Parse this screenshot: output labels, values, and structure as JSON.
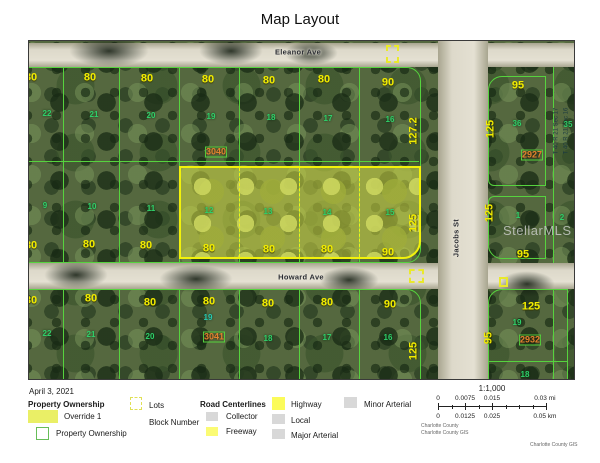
{
  "title": "Map Layout",
  "date": "April 3, 2021",
  "map": {
    "section": {
      "line1": "T 40  R 21  Sec 17",
      "line2": "T 40  R 21  Sec 16"
    },
    "watermark": "StellarMLS",
    "labels": [
      {
        "t": "80",
        "x": 2,
        "y": 37,
        "c": "w"
      },
      {
        "t": "80",
        "x": 61,
        "y": 37,
        "c": "w"
      },
      {
        "t": "80",
        "x": 118,
        "y": 38,
        "c": "w"
      },
      {
        "t": "80",
        "x": 179,
        "y": 39,
        "c": "w"
      },
      {
        "t": "80",
        "x": 240,
        "y": 40,
        "c": "w"
      },
      {
        "t": "80",
        "x": 295,
        "y": 39,
        "c": "w"
      },
      {
        "t": "90",
        "x": 359,
        "y": 42,
        "c": "w"
      },
      {
        "t": "95",
        "x": 489,
        "y": 45,
        "c": "w"
      },
      {
        "t": "80",
        "x": 2,
        "y": 205,
        "c": "w"
      },
      {
        "t": "80",
        "x": 60,
        "y": 204,
        "c": "w"
      },
      {
        "t": "80",
        "x": 117,
        "y": 205,
        "c": "w"
      },
      {
        "t": "80",
        "x": 180,
        "y": 208,
        "c": "w"
      },
      {
        "t": "80",
        "x": 240,
        "y": 209,
        "c": "w"
      },
      {
        "t": "80",
        "x": 298,
        "y": 209,
        "c": "w"
      },
      {
        "t": "90",
        "x": 359,
        "y": 212,
        "c": "w"
      },
      {
        "t": "95",
        "x": 494,
        "y": 214,
        "c": "w"
      },
      {
        "t": "80",
        "x": 2,
        "y": 260,
        "c": "w"
      },
      {
        "t": "80",
        "x": 62,
        "y": 258,
        "c": "w"
      },
      {
        "t": "80",
        "x": 121,
        "y": 262,
        "c": "w"
      },
      {
        "t": "80",
        "x": 180,
        "y": 261,
        "c": "w"
      },
      {
        "t": "80",
        "x": 239,
        "y": 263,
        "c": "w"
      },
      {
        "t": "80",
        "x": 298,
        "y": 262,
        "c": "w"
      },
      {
        "t": "90",
        "x": 361,
        "y": 264,
        "c": "w"
      },
      {
        "t": "125",
        "x": 502,
        "y": 266,
        "c": "w"
      },
      {
        "t": "22",
        "x": 18,
        "y": 73,
        "c": "lot"
      },
      {
        "t": "21",
        "x": 65,
        "y": 74,
        "c": "lot"
      },
      {
        "t": "20",
        "x": 122,
        "y": 75,
        "c": "lot"
      },
      {
        "t": "19",
        "x": 182,
        "y": 76,
        "c": "lot"
      },
      {
        "t": "18",
        "x": 242,
        "y": 77,
        "c": "lot"
      },
      {
        "t": "17",
        "x": 299,
        "y": 78,
        "c": "lot"
      },
      {
        "t": "16",
        "x": 361,
        "y": 79,
        "c": "lot"
      },
      {
        "t": "36",
        "x": 488,
        "y": 83,
        "c": "lot"
      },
      {
        "t": "35",
        "x": 539,
        "y": 84,
        "c": "lot"
      },
      {
        "t": "9",
        "x": 16,
        "y": 165,
        "c": "lot"
      },
      {
        "t": "10",
        "x": 63,
        "y": 166,
        "c": "lot"
      },
      {
        "t": "11",
        "x": 122,
        "y": 168,
        "c": "lot"
      },
      {
        "t": "12",
        "x": 180,
        "y": 170,
        "c": "lot"
      },
      {
        "t": "13",
        "x": 239,
        "y": 171,
        "c": "lot"
      },
      {
        "t": "14",
        "x": 298,
        "y": 172,
        "c": "lot"
      },
      {
        "t": "15",
        "x": 361,
        "y": 172,
        "c": "lot"
      },
      {
        "t": "1",
        "x": 489,
        "y": 175,
        "c": "lot"
      },
      {
        "t": "2",
        "x": 533,
        "y": 177,
        "c": "lot"
      },
      {
        "t": "22",
        "x": 18,
        "y": 293,
        "c": "lot"
      },
      {
        "t": "21",
        "x": 62,
        "y": 294,
        "c": "lot"
      },
      {
        "t": "20",
        "x": 121,
        "y": 296,
        "c": "lot"
      },
      {
        "t": "19",
        "x": 179,
        "y": 277,
        "c": "lotteal"
      },
      {
        "t": "18",
        "x": 239,
        "y": 298,
        "c": "lot"
      },
      {
        "t": "17",
        "x": 298,
        "y": 297,
        "c": "lot"
      },
      {
        "t": "16",
        "x": 359,
        "y": 297,
        "c": "lot"
      },
      {
        "t": "19",
        "x": 488,
        "y": 282,
        "c": "lot"
      },
      {
        "t": "18",
        "x": 496,
        "y": 334,
        "c": "lot"
      },
      {
        "t": "3040",
        "x": 187,
        "y": 111,
        "c": "blk"
      },
      {
        "t": "3041",
        "x": 185,
        "y": 296,
        "c": "blk"
      },
      {
        "t": "2927",
        "x": 503,
        "y": 114,
        "c": "blk"
      },
      {
        "t": "2932",
        "x": 501,
        "y": 299,
        "c": "blk"
      },
      {
        "t": "127.2",
        "x": 385,
        "y": 90,
        "c": "dep",
        "r": -90
      },
      {
        "t": "125",
        "x": 385,
        "y": 182,
        "c": "dep",
        "r": -90
      },
      {
        "t": "125",
        "x": 462,
        "y": 88,
        "c": "dep",
        "r": -90
      },
      {
        "t": "125",
        "x": 461,
        "y": 172,
        "c": "dep",
        "r": -90
      },
      {
        "t": "125",
        "x": 385,
        "y": 310,
        "c": "dep",
        "r": -90
      },
      {
        "t": "95",
        "x": 460,
        "y": 297,
        "c": "dep",
        "r": -90
      },
      {
        "t": "Eleanor Ave",
        "x": 269,
        "y": 11,
        "c": "street"
      },
      {
        "t": "Howard Ave",
        "x": 272,
        "y": 236,
        "c": "street"
      },
      {
        "t": "Jacobs St",
        "x": 427,
        "y": 197,
        "c": "street",
        "r": -90
      }
    ]
  },
  "legend": {
    "property_ownership_title": "Property Ownership",
    "override_label": "Override 1",
    "property_ownership_label": "Property Ownership",
    "lots_label": "Lots",
    "block_number_label": "Block Number",
    "road_centerlines_title": "Road Centerlines",
    "collector_label": "Collector",
    "freeway_label": "Freeway",
    "highway_label": "Highway",
    "local_label": "Local",
    "major_arterial_label": "Major Arterial",
    "minor_arterial_label": "Minor Arterial"
  },
  "scalebar": {
    "ratio": "1:1,000",
    "mi": [
      "0",
      "0.0075",
      "0.015",
      "0.03 mi"
    ],
    "km": [
      "0",
      "0.0125",
      "0.025",
      "0.05 km"
    ],
    "source1": "Charlotte County",
    "source2": "Charlotte County GIS"
  },
  "credit": "Charlotte County GIS",
  "colors": {
    "parcel_line_green": "#56d33e",
    "highlight_yellow": "#f2f20a",
    "dimension_yellow": "#f2ec00",
    "lot_number_green": "#2fd06a",
    "block_number_orange": "#e0832f",
    "road_gray": "#ddd9ca"
  }
}
